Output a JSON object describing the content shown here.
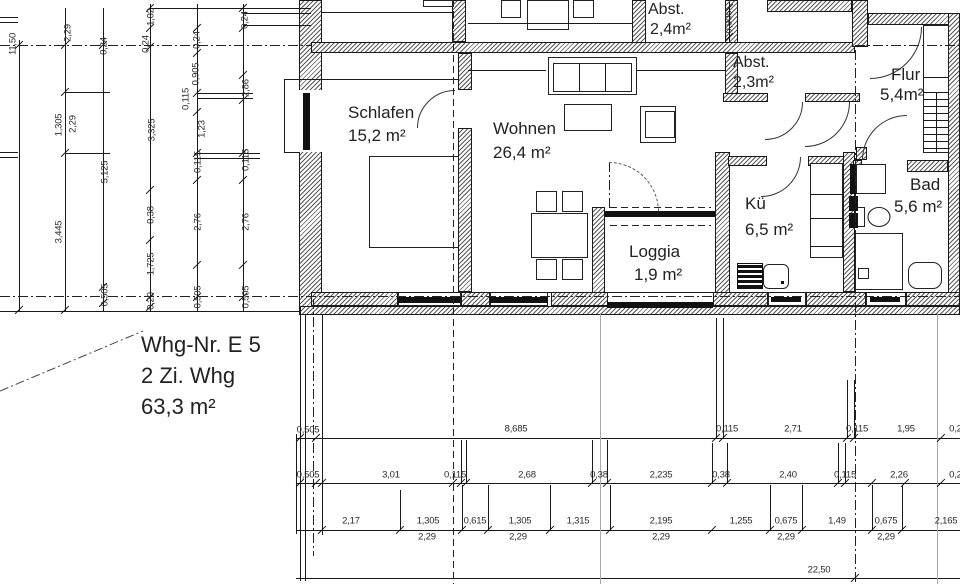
{
  "title_block": {
    "line1": "Whg-Nr. E 5",
    "line2": "2 Zi. Whg",
    "line3": "63,3 m²"
  },
  "rooms": [
    {
      "name": "Schlafen",
      "area": "15,2 m²",
      "nx": 348,
      "ny": 103,
      "ax": 348,
      "ay": 126,
      "fs": 17
    },
    {
      "name": "Wohnen",
      "area": "26,4 m²",
      "nx": 493,
      "ny": 119,
      "ax": 493,
      "ay": 143,
      "fs": 17
    },
    {
      "name": "Abst.",
      "area": "2,4m²",
      "nx": 648,
      "ny": 1,
      "ax": 650,
      "ay": 21,
      "fs": 16
    },
    {
      "name": "Abst.",
      "area": "2,3m²",
      "nx": 733,
      "ny": 54,
      "ax": 733,
      "ay": 74,
      "fs": 16
    },
    {
      "name": "Flur",
      "area": "5,4m²",
      "nx": 891,
      "ny": 65,
      "ax": 880,
      "ay": 85,
      "fs": 17
    },
    {
      "name": "Kü",
      "area": "6,5 m²",
      "nx": 745,
      "ny": 194,
      "ax": 745,
      "ay": 220,
      "fs": 17
    },
    {
      "name": "Bad",
      "area": "5,6 m²",
      "nx": 910,
      "ny": 175,
      "ax": 894,
      "ay": 197,
      "fs": 17
    },
    {
      "name": "Loggia",
      "area": "1,9 m²",
      "nx": 629,
      "ny": 242,
      "ax": 634,
      "ay": 265,
      "fs": 17
    }
  ],
  "dims_vertical": [
    {
      "t": "11,50",
      "x": 13,
      "y": 44
    },
    {
      "t": "2,29",
      "x": 68,
      "y": 33
    },
    {
      "t": "0,24",
      "x": 104,
      "y": 46
    },
    {
      "t": "1,02",
      "x": 151,
      "y": 17
    },
    {
      "t": "0,24",
      "x": 146,
      "y": 44
    },
    {
      "t": "0,24",
      "x": 197,
      "y": 40
    },
    {
      "t": "0,24",
      "x": 245,
      "y": 20
    },
    {
      "t": "0,905",
      "x": 196,
      "y": 74
    },
    {
      "t": "0,115",
      "x": 186,
      "y": 99
    },
    {
      "t": "2,86",
      "x": 246,
      "y": 88
    },
    {
      "t": "1,305",
      "x": 59,
      "y": 125
    },
    {
      "t": "2,29",
      "x": 73,
      "y": 124
    },
    {
      "t": "3,325",
      "x": 152,
      "y": 130
    },
    {
      "t": "1,23",
      "x": 202,
      "y": 129
    },
    {
      "t": "5,125",
      "x": 105,
      "y": 172
    },
    {
      "t": "0,115",
      "x": 198,
      "y": 162
    },
    {
      "t": "0,115",
      "x": 246,
      "y": 160
    },
    {
      "t": "0,38",
      "x": 151,
      "y": 215
    },
    {
      "t": "2,76",
      "x": 198,
      "y": 222
    },
    {
      "t": "2,76",
      "x": 246,
      "y": 222
    },
    {
      "t": "3,445",
      "x": 59,
      "y": 232
    },
    {
      "t": "1,725",
      "x": 151,
      "y": 264
    },
    {
      "t": "0,505",
      "x": 105,
      "y": 295
    },
    {
      "t": "0,20",
      "x": 151,
      "y": 301
    },
    {
      "t": "0,505",
      "x": 198,
      "y": 297
    },
    {
      "t": "0,505",
      "x": 246,
      "y": 297
    },
    {
      "t": "0,905",
      "x": 729,
      "y": 22
    }
  ],
  "dims_horizontal": [
    {
      "t": "0,505",
      "x": 308,
      "y": 430
    },
    {
      "t": "8,685",
      "x": 516,
      "y": 429
    },
    {
      "t": "0,115",
      "x": 727,
      "y": 429
    },
    {
      "t": "2,71",
      "x": 793,
      "y": 429
    },
    {
      "t": "0,115",
      "x": 857,
      "y": 429
    },
    {
      "t": "1,95",
      "x": 906,
      "y": 429
    },
    {
      "t": "0,24",
      "x": 958,
      "y": 429
    },
    {
      "t": "0,505",
      "x": 308,
      "y": 475
    },
    {
      "t": "3,01",
      "x": 391,
      "y": 475
    },
    {
      "t": "0,115",
      "x": 455,
      "y": 475
    },
    {
      "t": "2,68",
      "x": 527,
      "y": 475
    },
    {
      "t": "0,38",
      "x": 599,
      "y": 475
    },
    {
      "t": "2,235",
      "x": 661,
      "y": 475
    },
    {
      "t": "0,38",
      "x": 721,
      "y": 475
    },
    {
      "t": "2,40",
      "x": 788,
      "y": 475
    },
    {
      "t": "0,115",
      "x": 845,
      "y": 475
    },
    {
      "t": "2,26",
      "x": 899,
      "y": 475
    },
    {
      "t": "0,24",
      "x": 958,
      "y": 475
    },
    {
      "t": "2,17",
      "x": 351,
      "y": 521
    },
    {
      "t": "1,305",
      "x": 428,
      "y": 521
    },
    {
      "t": "0,615",
      "x": 475,
      "y": 521
    },
    {
      "t": "1,305",
      "x": 520,
      "y": 521
    },
    {
      "t": "1,315",
      "x": 578,
      "y": 521
    },
    {
      "t": "2,195",
      "x": 661,
      "y": 521
    },
    {
      "t": "1,255",
      "x": 741,
      "y": 521
    },
    {
      "t": "0,675",
      "x": 786,
      "y": 521
    },
    {
      "t": "1,49",
      "x": 837,
      "y": 521
    },
    {
      "t": "0,675",
      "x": 886,
      "y": 521
    },
    {
      "t": "2,165",
      "x": 946,
      "y": 521
    },
    {
      "t": "2,29",
      "x": 427,
      "y": 537
    },
    {
      "t": "2,29",
      "x": 518,
      "y": 537
    },
    {
      "t": "2,29",
      "x": 661,
      "y": 537
    },
    {
      "t": "2,29",
      "x": 786,
      "y": 537
    },
    {
      "t": "2,29",
      "x": 886,
      "y": 537
    },
    {
      "t": "22,50",
      "x": 819,
      "y": 570
    }
  ],
  "geometry": {
    "walls": [
      [
        299,
        0,
        23,
        93
      ],
      [
        299,
        150,
        23,
        165
      ],
      [
        311,
        42,
        544,
        11
      ],
      [
        452,
        0,
        14,
        42
      ],
      [
        632,
        0,
        14,
        43
      ],
      [
        725,
        0,
        13,
        43
      ],
      [
        767,
        0,
        85,
        12
      ],
      [
        852,
        0,
        16,
        47
      ],
      [
        868,
        13,
        92,
        12
      ],
      [
        948,
        13,
        12,
        302
      ],
      [
        458,
        53,
        14,
        37
      ],
      [
        458,
        128,
        14,
        164
      ],
      [
        725,
        53,
        13,
        49
      ],
      [
        723,
        93,
        45,
        9
      ],
      [
        805,
        93,
        55,
        9
      ],
      [
        715,
        152,
        15,
        156
      ],
      [
        728,
        156,
        39,
        10
      ],
      [
        808,
        156,
        39,
        10
      ],
      [
        843,
        152,
        12,
        140
      ],
      [
        853,
        160,
        9,
        12
      ],
      [
        907,
        160,
        41,
        12
      ],
      [
        856,
        147,
        11,
        13
      ],
      [
        592,
        207,
        13,
        101
      ],
      [
        311,
        292,
        87,
        14
      ],
      [
        461,
        292,
        29,
        14
      ],
      [
        551,
        292,
        57,
        14
      ],
      [
        713,
        292,
        55,
        14
      ],
      [
        806,
        292,
        60,
        14
      ],
      [
        906,
        292,
        54,
        14
      ],
      [
        300,
        306,
        660,
        9
      ]
    ],
    "whites": [
      [
        297,
        90,
        25,
        62
      ]
    ],
    "whiteframes": [
      [
        768,
        292,
        38,
        14
      ],
      [
        866,
        292,
        40,
        14
      ],
      [
        398,
        292,
        63,
        14
      ],
      [
        490,
        292,
        58,
        14
      ]
    ],
    "solids": [
      [
        398,
        297,
        63,
        6
      ],
      [
        490,
        297,
        58,
        6
      ],
      [
        303,
        93,
        7,
        57
      ],
      [
        605,
        211,
        110,
        6
      ],
      [
        607,
        302,
        106,
        6
      ],
      [
        771,
        297,
        30,
        5
      ],
      [
        870,
        297,
        30,
        5
      ],
      [
        850,
        164,
        6,
        30
      ],
      [
        849,
        196,
        9,
        15
      ],
      [
        849,
        213,
        9,
        15
      ],
      [
        781,
        281,
        3,
        3
      ]
    ],
    "rects": [
      [
        369,
        156,
        90,
        92
      ],
      [
        548,
        57,
        89,
        38
      ],
      [
        553,
        63,
        79,
        29
      ],
      [
        564,
        104,
        48,
        27
      ],
      [
        640,
        106,
        36,
        37
      ],
      [
        645,
        111,
        30,
        27
      ],
      [
        531,
        213,
        57,
        45
      ],
      [
        536,
        191,
        21,
        21
      ],
      [
        562,
        191,
        21,
        21
      ],
      [
        536,
        259,
        21,
        21
      ],
      [
        562,
        259,
        21,
        21
      ],
      [
        501,
        0,
        20,
        18
      ],
      [
        527,
        0,
        42,
        30
      ],
      [
        573,
        0,
        21,
        18
      ],
      [
        423,
        0,
        30,
        7
      ],
      [
        810,
        163,
        33,
        95
      ],
      [
        856,
        164,
        30,
        30
      ],
      [
        855,
        207,
        10,
        20
      ],
      [
        855,
        233,
        48,
        57
      ],
      [
        858,
        268,
        11,
        11
      ],
      [
        908,
        262,
        34,
        27,
        9
      ],
      [
        763,
        264,
        26,
        25,
        6
      ],
      [
        923,
        25,
        26,
        128
      ]
    ],
    "grills": [
      [
        737,
        263,
        26,
        26
      ]
    ],
    "hlines": [
      [
        322,
        12,
        130,
        ""
      ],
      [
        468,
        23,
        164,
        ""
      ],
      [
        243,
        13,
        68,
        ""
      ],
      [
        243,
        25,
        68,
        ""
      ],
      [
        150,
        8,
        161,
        ""
      ],
      [
        0,
        17,
        18,
        ""
      ],
      [
        0,
        22,
        18,
        ""
      ],
      [
        0,
        152,
        18,
        ""
      ],
      [
        0,
        157,
        18,
        ""
      ],
      [
        65,
        92,
        45,
        ""
      ],
      [
        65,
        153,
        45,
        ""
      ],
      [
        197,
        93,
        56,
        ""
      ],
      [
        197,
        98,
        56,
        ""
      ],
      [
        195,
        153,
        65,
        ""
      ],
      [
        195,
        158,
        65,
        ""
      ],
      [
        284,
        79,
        174,
        ""
      ],
      [
        284,
        152,
        16,
        ""
      ],
      [
        468,
        70,
        78,
        ""
      ],
      [
        637,
        70,
        88,
        ""
      ],
      [
        311,
        292,
        637,
        ""
      ],
      [
        0,
        311,
        300,
        ""
      ],
      [
        810,
        194,
        33,
        ""
      ],
      [
        810,
        218,
        33,
        ""
      ],
      [
        810,
        246,
        33,
        ""
      ],
      [
        923,
        77,
        26,
        ""
      ],
      [
        923,
        92,
        26,
        ""
      ],
      [
        923,
        99,
        26,
        ""
      ],
      [
        923,
        106,
        26,
        ""
      ],
      [
        923,
        113,
        26,
        ""
      ],
      [
        923,
        120,
        26,
        ""
      ],
      [
        923,
        127,
        26,
        ""
      ],
      [
        923,
        134,
        26,
        ""
      ],
      [
        923,
        141,
        26,
        ""
      ],
      [
        923,
        148,
        26,
        ""
      ],
      [
        296,
        438,
        664,
        ""
      ],
      [
        296,
        483,
        664,
        ""
      ],
      [
        296,
        530,
        664,
        ""
      ],
      [
        296,
        578,
        664,
        ""
      ],
      [
        610,
        207,
        101,
        "dash"
      ],
      [
        610,
        225,
        101,
        "dash"
      ],
      [
        0,
        45,
        311,
        "dashdot"
      ],
      [
        855,
        45,
        105,
        "dashdot"
      ],
      [
        0,
        296,
        960,
        "dashdot"
      ]
    ],
    "vlines": [
      [
        19,
        40,
        271,
        ""
      ],
      [
        65,
        8,
        303,
        ""
      ],
      [
        103,
        8,
        303,
        ""
      ],
      [
        150,
        4,
        307,
        ""
      ],
      [
        197,
        4,
        307,
        ""
      ],
      [
        243,
        4,
        307,
        ""
      ],
      [
        729,
        2,
        41,
        ""
      ],
      [
        284,
        79,
        74,
        ""
      ],
      [
        579,
        63,
        29,
        ""
      ],
      [
        605,
        63,
        29,
        ""
      ],
      [
        936,
        92,
        60,
        ""
      ],
      [
        300,
        315,
        266,
        ""
      ],
      [
        305,
        315,
        266,
        ""
      ],
      [
        322,
        315,
        220,
        ""
      ],
      [
        716,
        318,
        120,
        ""
      ],
      [
        723,
        318,
        120,
        ""
      ],
      [
        847,
        380,
        58,
        ""
      ],
      [
        854,
        380,
        58,
        ""
      ],
      [
        461,
        440,
        43,
        ""
      ],
      [
        466,
        440,
        43,
        ""
      ],
      [
        592,
        440,
        43,
        ""
      ],
      [
        607,
        440,
        43,
        ""
      ],
      [
        712,
        443,
        40,
        ""
      ],
      [
        727,
        443,
        40,
        ""
      ],
      [
        838,
        443,
        40,
        ""
      ],
      [
        845,
        443,
        40,
        ""
      ],
      [
        400,
        490,
        40,
        ""
      ],
      [
        462,
        485,
        45,
        ""
      ],
      [
        488,
        485,
        45,
        ""
      ],
      [
        550,
        485,
        45,
        ""
      ],
      [
        610,
        485,
        45,
        ""
      ],
      [
        770,
        485,
        45,
        ""
      ],
      [
        802,
        485,
        45,
        ""
      ],
      [
        872,
        485,
        45,
        ""
      ],
      [
        902,
        485,
        45,
        ""
      ],
      [
        296,
        434,
        100,
        ""
      ],
      [
        600,
        313,
        271,
        "gray"
      ],
      [
        937,
        313,
        271,
        "gray"
      ],
      [
        453,
        0,
        584,
        "dash"
      ],
      [
        855,
        50,
        534,
        "dashdot"
      ],
      [
        313,
        299,
        257,
        "dashdot"
      ],
      [
        609,
        162,
        50,
        "dashdot"
      ]
    ],
    "ticks": [
      [
        300,
        438
      ],
      [
        316,
        438
      ],
      [
        716,
        438
      ],
      [
        723,
        438
      ],
      [
        847,
        438
      ],
      [
        854,
        438
      ],
      [
        941,
        438
      ],
      [
        300,
        483
      ],
      [
        316,
        483
      ],
      [
        322,
        483
      ],
      [
        453,
        483
      ],
      [
        461,
        483
      ],
      [
        466,
        483
      ],
      [
        592,
        483
      ],
      [
        607,
        483
      ],
      [
        712,
        483
      ],
      [
        727,
        483
      ],
      [
        838,
        483
      ],
      [
        845,
        483
      ],
      [
        872,
        483
      ],
      [
        905,
        483
      ],
      [
        941,
        483
      ],
      [
        322,
        530
      ],
      [
        400,
        530
      ],
      [
        462,
        530
      ],
      [
        488,
        530
      ],
      [
        550,
        530
      ],
      [
        610,
        530
      ],
      [
        712,
        530
      ],
      [
        770,
        530
      ],
      [
        802,
        530
      ],
      [
        872,
        530
      ],
      [
        902,
        530
      ],
      [
        855,
        578
      ],
      [
        19,
        45
      ],
      [
        19,
        310
      ],
      [
        65,
        45
      ],
      [
        65,
        92
      ],
      [
        65,
        153
      ],
      [
        65,
        310
      ],
      [
        103,
        45
      ],
      [
        103,
        287
      ],
      [
        103,
        303
      ],
      [
        150,
        8
      ],
      [
        150,
        28
      ],
      [
        150,
        47
      ],
      [
        150,
        190
      ],
      [
        150,
        240
      ],
      [
        150,
        297
      ],
      [
        150,
        307
      ],
      [
        197,
        28
      ],
      [
        197,
        53
      ],
      [
        197,
        93
      ],
      [
        197,
        112
      ],
      [
        197,
        153
      ],
      [
        197,
        180
      ],
      [
        197,
        265
      ],
      [
        197,
        297
      ],
      [
        243,
        8
      ],
      [
        243,
        28
      ],
      [
        243,
        75
      ],
      [
        243,
        100
      ],
      [
        243,
        153
      ],
      [
        243,
        180
      ],
      [
        243,
        265
      ],
      [
        243,
        297
      ],
      [
        729,
        8
      ],
      [
        729,
        37
      ]
    ],
    "arcs": [
      [
        417,
        90,
        38,
        "tl",
        false
      ],
      [
        765,
        102,
        38,
        "br",
        false
      ],
      [
        805,
        102,
        45,
        "br",
        false
      ],
      [
        761,
        157,
        40,
        "br",
        false
      ],
      [
        870,
        27,
        52,
        "br",
        false
      ],
      [
        862,
        115,
        45,
        "tl",
        false
      ],
      [
        609,
        162,
        50,
        "tr",
        true
      ]
    ]
  }
}
